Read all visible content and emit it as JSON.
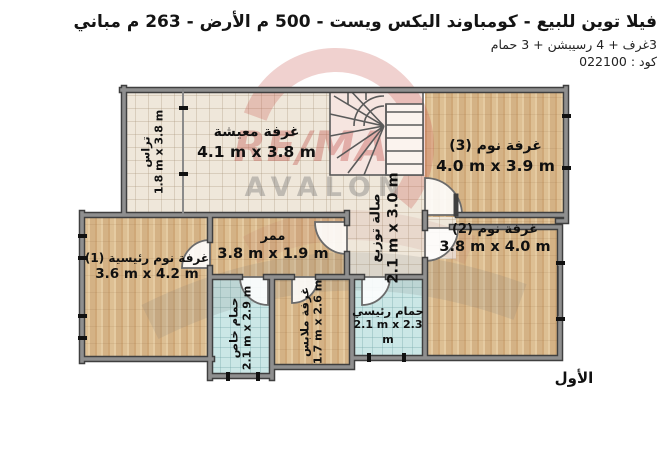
{
  "header": {
    "title": "فيلا توين للبيع - كومباوند اليكس ويست - 500 م الأرض - 263 م مباني",
    "subtitle": "3غرف + 4 رسيبشن + 3 حمام",
    "code": "كود : 022100"
  },
  "floor_label": "الأول",
  "watermark": {
    "line1": "RE/MAX",
    "line2": "AVALON",
    "red": "#b93732",
    "gray": "#7d7d7d"
  },
  "rooms": {
    "terrace": {
      "name": "تراس",
      "dims": "1.8 m x 3.8 m"
    },
    "living": {
      "name": "غرفة معيشة",
      "dims": "4.1 m x 3.8 m"
    },
    "bedroom3": {
      "name": "غرفة نوم (3)",
      "dims": "4.0 m x 3.9 m"
    },
    "hall": {
      "name": "صالة توزيع",
      "dims": "2.1 m x 3.0 m"
    },
    "corridor": {
      "name": "ممر",
      "dims": "3.8 m x 1.9 m"
    },
    "master": {
      "name": "غرفة نوم رئيسية (1)",
      "dims": "3.6 m x 4.2 m"
    },
    "bedroom2": {
      "name": "غرفة نوم (2)",
      "dims": "3.8 m x 4.0 m"
    },
    "bath_private": {
      "name": "حمام خاص",
      "dims": "2.1 m x 2.9 m"
    },
    "dressing": {
      "name": "غرفة ملابس",
      "dims": "1.7 m x 2.6 m"
    },
    "bath_main": {
      "name": "حمام رئيسي",
      "dims": "2.1 m x 2.3 m"
    }
  },
  "colors": {
    "wall": "#8f8f8f",
    "wall_edge": "#3f3f3f",
    "wood_floor": "#d9b98c",
    "beige_tile": "#efe7da",
    "blue_tile": "#cbe7e6",
    "text": "#111111"
  }
}
